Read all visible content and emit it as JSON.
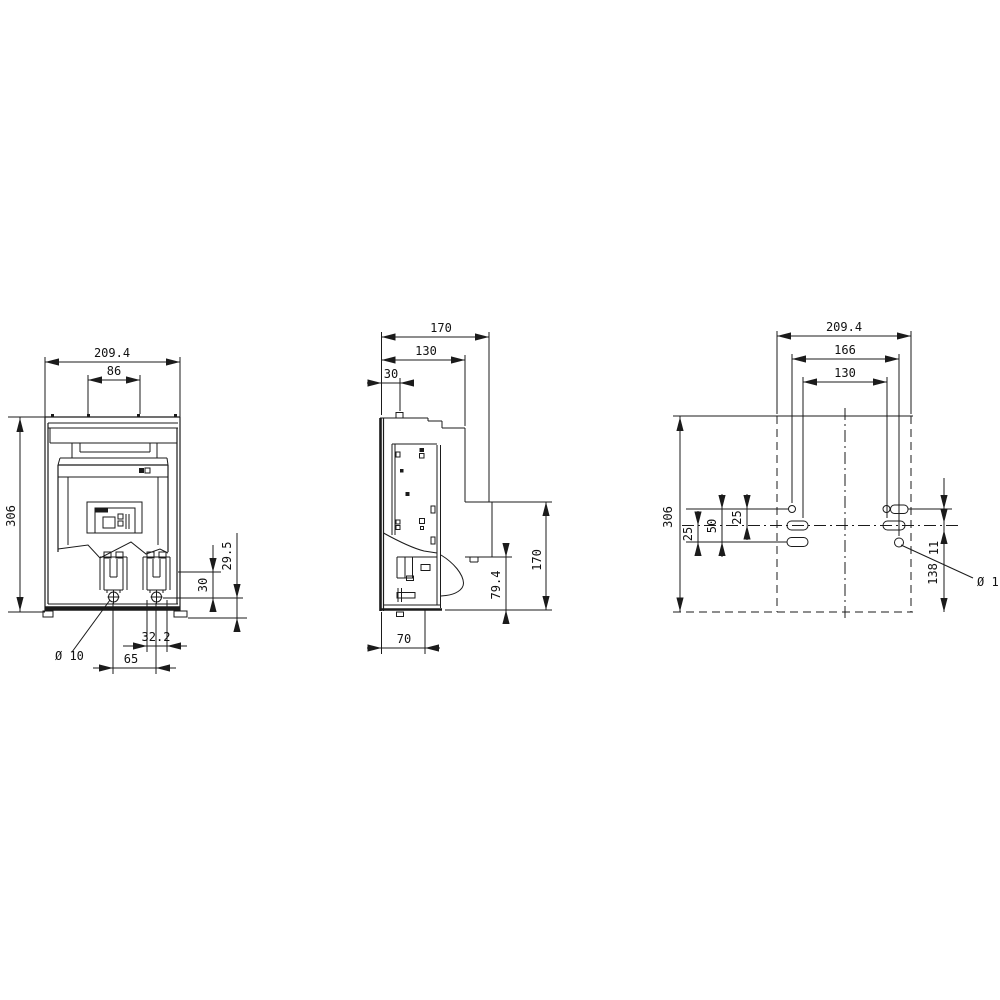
{
  "drawing_type": "dimension-drawing",
  "colors": {
    "line": "#1b1b1b",
    "background": "#ffffff"
  },
  "views": {
    "front": {
      "d209": "209.4",
      "d86": "86",
      "d306": "306",
      "d295": "29.5",
      "d30": "30",
      "d322": "32.2",
      "d65": "65",
      "hole": "Ø 10"
    },
    "side": {
      "d170top": "170",
      "d130": "130",
      "d30": "30",
      "d70": "70",
      "d794": "79.4",
      "d170right": "170"
    },
    "drill": {
      "d209": "209.4",
      "d166": "166",
      "d130": "130",
      "d306": "306",
      "d25a": "25",
      "d50": "50",
      "d25b": "25",
      "d11": "11",
      "d138": "138",
      "hole": "Ø 11"
    }
  }
}
